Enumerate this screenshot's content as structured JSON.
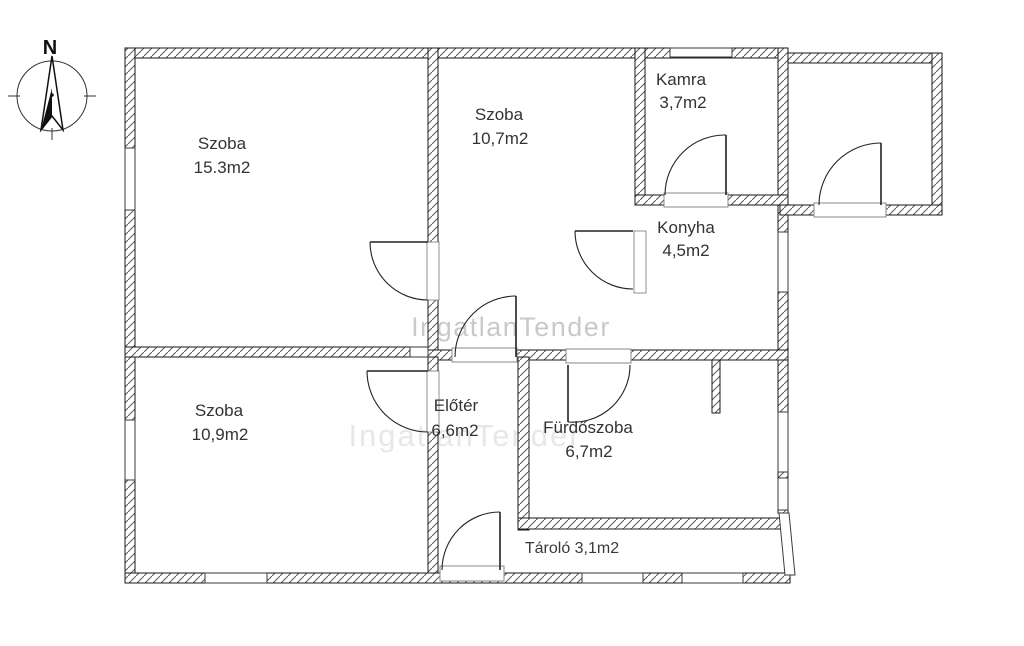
{
  "page_title": "Floor plan",
  "compass": {
    "north_label": "N"
  },
  "watermark": {
    "text": "IngatlanTender",
    "color": "#c9c9c9"
  },
  "watermark_faint": {
    "text": "IngatlanTender"
  },
  "rooms": [
    {
      "name": "Szoba",
      "area": "15.3m2"
    },
    {
      "name": "Szoba",
      "area": "10,7m2"
    },
    {
      "name": "Kamra",
      "area": "3,7m2"
    },
    {
      "name": "Konyha",
      "area": "4,5m2"
    },
    {
      "name": "Szoba",
      "area": "10,9m2"
    },
    {
      "name": "Előtér",
      "area": "6,6m2"
    },
    {
      "name": "Fürdőszoba",
      "area": "6,7m2"
    },
    {
      "name": "Tároló",
      "area": "3,1m2",
      "label": "Tároló 3,1m2"
    }
  ],
  "colors": {
    "wall_line": "#1a1a1a",
    "hatch": "#5a5a5a",
    "label_text": "#333333",
    "watermark_gray": "#c9c9c9"
  }
}
